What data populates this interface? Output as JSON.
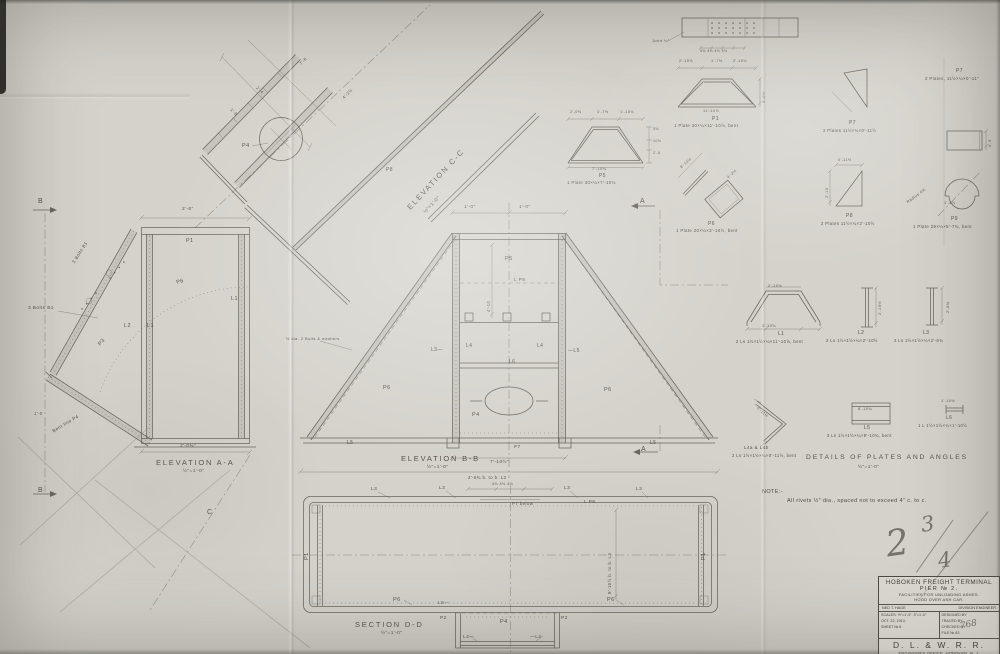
{
  "title_block": {
    "title": "HOBOKEN FREIGHT TERMINAL",
    "subtitle": "PIER № 2.",
    "line1": "FACILITIES FOR UNLOADING ASHES.",
    "line2": "HOOD OVER ASH CAR.",
    "engineer_name": "NED T. HAGE",
    "engineer_title": "DIVISION ENGINEER",
    "scales": "SCALES: ½″=1'-0″, 3″=1'-0″",
    "date": "OCT. 22, 1913.",
    "sheet": "SHEET № 6",
    "designed_by": "DESIGNED BY",
    "traced_by": "TRACED BY",
    "checked_by": "CHECKED BY",
    "file": "FILE № 63",
    "railroad": "D. L. & W. R. R.",
    "office": "ENGINEER'S OFFICE, HOBOKEN, N. J.",
    "chief": "G. J. RAY, CHIEF ENGINEER."
  },
  "pencil_mark": {
    "value": "2 3/4",
    "whole": "2",
    "numerator": "3",
    "denominator": "4",
    "check_mark": "768"
  },
  "note": {
    "heading": "NOTE:-",
    "text": "All rivets ½″ dia., spaced not to exceed 4″ c. to c."
  },
  "views": [
    {
      "id": "elevation-cc",
      "title": "ELEVATION C-C",
      "scale": "½″=1'-0″",
      "tx": 406,
      "ty": 206,
      "ts": 7.5,
      "tr": -47,
      "sx": 424,
      "sy": 212
    },
    {
      "id": "elevation-aa",
      "title": "ELEVATION A-A",
      "scale": "½″=1'-0″",
      "tx": 156,
      "ty": 459,
      "ts": 7.5,
      "tr": 0,
      "sx": 183,
      "sy": 470
    },
    {
      "id": "elevation-bb",
      "title": "ELEVATION B-B",
      "scale": "½″=1'-0″",
      "tx": 401,
      "ty": 455,
      "ts": 7.5,
      "tr": 0,
      "sx": 427,
      "sy": 466
    },
    {
      "id": "section-dd",
      "title": "SECTION D-D",
      "scale": "½″=1'-0″",
      "tx": 355,
      "ty": 621,
      "ts": 7.5,
      "tr": 0,
      "sx": 381,
      "sy": 632
    },
    {
      "id": "details",
      "title": "DETAILS OF PLATES AND ANGLES",
      "scale": "½″=1'-0″",
      "tx": 806,
      "ty": 455,
      "ts": 6.8,
      "tr": 0,
      "sx": 858,
      "sy": 466
    }
  ],
  "annotations": [
    {
      "t": "P4",
      "x": 242,
      "y": 144,
      "s": 5.5
    },
    {
      "t": "P8",
      "x": 386,
      "y": 168,
      "s": 5
    },
    {
      "t": "7'-6",
      "x": 299,
      "y": 63,
      "s": 4.2,
      "r": -46
    },
    {
      "t": "4'-2½",
      "x": 342,
      "y": 97,
      "s": 4.2,
      "r": -46
    },
    {
      "t": "2'-4",
      "x": 258,
      "y": 86,
      "s": 4.2,
      "r": 44
    },
    {
      "t": "1'-8",
      "x": 232,
      "y": 108,
      "s": 4.2,
      "r": 44
    },
    {
      "t": "B",
      "x": 38,
      "y": 198,
      "s": 7
    },
    {
      "t": "B",
      "x": 38,
      "y": 487,
      "s": 7
    },
    {
      "t": "2'-6″",
      "x": 182,
      "y": 208,
      "s": 4.8
    },
    {
      "t": "P1",
      "x": 186,
      "y": 239,
      "s": 5.5
    },
    {
      "t": "P6",
      "x": 176,
      "y": 281,
      "s": 5.5,
      "r": -14
    },
    {
      "t": "L2",
      "x": 124,
      "y": 324,
      "s": 5.5
    },
    {
      "t": "L1",
      "x": 147,
      "y": 324,
      "s": 5.5
    },
    {
      "t": "L1",
      "x": 231,
      "y": 297,
      "s": 5.5
    },
    {
      "t": "3 Bolts B1",
      "x": 28,
      "y": 307,
      "s": 4.8
    },
    {
      "t": "3 Bolts B1",
      "x": 72,
      "y": 262,
      "s": 4.5,
      "r": -58
    },
    {
      "t": "P3",
      "x": 98,
      "y": 344,
      "s": 5.5,
      "r": -50
    },
    {
      "t": "Bent line P4",
      "x": 52,
      "y": 430,
      "s": 4.6,
      "r": -31
    },
    {
      "t": "1'-0",
      "x": 34,
      "y": 412,
      "s": 4.2
    },
    {
      "t": "2'-0⅜″",
      "x": 180,
      "y": 445,
      "s": 4.8
    },
    {
      "t": "C",
      "x": 207,
      "y": 509,
      "s": 7
    },
    {
      "t": "1'-0″",
      "x": 464,
      "y": 206,
      "s": 4.8
    },
    {
      "t": "1'-0″",
      "x": 519,
      "y": 206,
      "s": 4.8
    },
    {
      "t": "A",
      "x": 640,
      "y": 198,
      "s": 7
    },
    {
      "t": "A",
      "x": 641,
      "y": 446,
      "s": 7
    },
    {
      "t": "P5",
      "x": 505,
      "y": 257,
      "s": 5.5
    },
    {
      "t": "L P8",
      "x": 514,
      "y": 279,
      "s": 4.8
    },
    {
      "t": "4'-10",
      "x": 487,
      "y": 312,
      "s": 4.2,
      "r": -90
    },
    {
      "t": "L3—",
      "x": 431,
      "y": 348,
      "s": 5
    },
    {
      "t": "L4",
      "x": 466,
      "y": 344,
      "s": 5
    },
    {
      "t": "L4",
      "x": 537,
      "y": 344,
      "s": 5
    },
    {
      "t": "—L5",
      "x": 568,
      "y": 349,
      "s": 5
    },
    {
      "t": "L6",
      "x": 509,
      "y": 360,
      "s": 5
    },
    {
      "t": "P6",
      "x": 383,
      "y": 386,
      "s": 5.5
    },
    {
      "t": "P6",
      "x": 604,
      "y": 388,
      "s": 5.5
    },
    {
      "t": "P4",
      "x": 472,
      "y": 413,
      "s": 5.5
    },
    {
      "t": "L5",
      "x": 347,
      "y": 441,
      "s": 5
    },
    {
      "t": "L5",
      "x": 650,
      "y": 441,
      "s": 5
    },
    {
      "t": "P7",
      "x": 514,
      "y": 446,
      "s": 4.8
    },
    {
      "t": "½ dia. 2 Bolts & washers",
      "x": 286,
      "y": 337,
      "s": 4
    },
    {
      "t": "7'-10½″",
      "x": 490,
      "y": 461,
      "s": 4.8
    },
    {
      "t": "2'-6¾ b. to b. L3",
      "x": 468,
      "y": 476,
      "s": 4.4
    },
    {
      "t": "4⅛ 4⅛ 4⅛",
      "x": 492,
      "y": 483,
      "s": 3.8
    },
    {
      "t": "L3",
      "x": 371,
      "y": 488,
      "s": 4.8
    },
    {
      "t": "L3",
      "x": 439,
      "y": 487,
      "s": 4.8
    },
    {
      "t": "L3",
      "x": 564,
      "y": 487,
      "s": 4.8
    },
    {
      "t": "L3",
      "x": 636,
      "y": 488,
      "s": 4.8
    },
    {
      "t": "P7 below",
      "x": 512,
      "y": 502,
      "s": 4.4
    },
    {
      "t": "L P8",
      "x": 584,
      "y": 501,
      "s": 4.8
    },
    {
      "t": "8'-10½ b. to b. L3",
      "x": 608,
      "y": 594,
      "s": 4.4,
      "r": -90
    },
    {
      "t": "P1",
      "x": 305,
      "y": 560,
      "s": 5.5,
      "r": -90
    },
    {
      "t": "P1",
      "x": 702,
      "y": 560,
      "s": 5.5,
      "r": -90
    },
    {
      "t": "P6",
      "x": 393,
      "y": 598,
      "s": 5.5
    },
    {
      "t": "P6",
      "x": 607,
      "y": 598,
      "s": 5.5
    },
    {
      "t": "L6—",
      "x": 438,
      "y": 602,
      "s": 4.8
    },
    {
      "t": "P2",
      "x": 440,
      "y": 617,
      "s": 4.8
    },
    {
      "t": "P2",
      "x": 561,
      "y": 617,
      "s": 4.8
    },
    {
      "t": "P4",
      "x": 500,
      "y": 620,
      "s": 5.5
    },
    {
      "t": "L4—",
      "x": 463,
      "y": 636,
      "s": 4.8
    },
    {
      "t": "—L4",
      "x": 530,
      "y": 636,
      "s": 4.8
    },
    {
      "t": "Joint ¼″",
      "x": 652,
      "y": 39,
      "s": 4
    },
    {
      "t": "4⅛ 4⅛ 4⅛ 4⅛",
      "x": 700,
      "y": 50,
      "s": 3.6
    },
    {
      "t": "2'-10⅛",
      "x": 679,
      "y": 60,
      "s": 3.8
    },
    {
      "t": "1'-7½",
      "x": 711,
      "y": 60,
      "s": 3.8
    },
    {
      "t": "2'-10⅛",
      "x": 733,
      "y": 60,
      "s": 3.8
    },
    {
      "t": "3'-0½",
      "x": 763,
      "y": 103,
      "s": 3.8,
      "r": -90
    },
    {
      "t": "11'-10⅞",
      "x": 703,
      "y": 110,
      "s": 3.8
    },
    {
      "t": "P1",
      "x": 712,
      "y": 117,
      "s": 5
    },
    {
      "t": "1 Plate 30×¼×11'-10⅞, bent",
      "x": 674,
      "y": 124,
      "s": 4.3
    },
    {
      "t": "2'-0⅜",
      "x": 570,
      "y": 111,
      "s": 3.8
    },
    {
      "t": "1'-7½",
      "x": 597,
      "y": 111,
      "s": 3.8
    },
    {
      "t": "1'-10⅛",
      "x": 620,
      "y": 111,
      "s": 3.8
    },
    {
      "t": "3⅛",
      "x": 653,
      "y": 128,
      "s": 3.6
    },
    {
      "t": "10¾",
      "x": 653,
      "y": 140,
      "s": 3.6
    },
    {
      "t": "2'-6",
      "x": 653,
      "y": 152,
      "s": 3.6
    },
    {
      "t": "7'-10⅛",
      "x": 592,
      "y": 167,
      "s": 4
    },
    {
      "t": "P5",
      "x": 599,
      "y": 174,
      "s": 5
    },
    {
      "t": "1 Plate 30×¼×7'-10⅛",
      "x": 567,
      "y": 181,
      "s": 4.3
    },
    {
      "t": "8'-10½",
      "x": 680,
      "y": 167,
      "s": 3.8,
      "r": -42
    },
    {
      "t": "4'-2½",
      "x": 727,
      "y": 177,
      "s": 3.8,
      "r": -42
    },
    {
      "t": "P6",
      "x": 708,
      "y": 222,
      "s": 5
    },
    {
      "t": "1 Plate 20×¼×3'-10½, bent",
      "x": 676,
      "y": 229,
      "s": 4.3
    },
    {
      "t": "P7",
      "x": 956,
      "y": 69,
      "s": 5
    },
    {
      "t": "2 Plates, 11½×¼×0'-11″",
      "x": 925,
      "y": 77,
      "s": 4.3
    },
    {
      "t": "P7",
      "x": 849,
      "y": 121,
      "s": 5
    },
    {
      "t": "2 Plates 11½×¼×0'-11½",
      "x": 823,
      "y": 129,
      "s": 4.2
    },
    {
      "t": "0'-11½",
      "x": 838,
      "y": 159,
      "s": 3.8
    },
    {
      "t": "2'-10",
      "x": 826,
      "y": 198,
      "s": 3.8,
      "r": -90
    },
    {
      "t": "P8",
      "x": 846,
      "y": 214,
      "s": 5
    },
    {
      "t": "2 Plates 11½×¼×2'-10½",
      "x": 821,
      "y": 222,
      "s": 4.2
    },
    {
      "t": "0'-9",
      "x": 989,
      "y": 147,
      "s": 3.8,
      "r": -90
    },
    {
      "t": "Radius 4¾",
      "x": 906,
      "y": 201,
      "s": 4,
      "r": -36
    },
    {
      "t": "1'-4⅞",
      "x": 944,
      "y": 202,
      "s": 3.8
    },
    {
      "t": "P9",
      "x": 951,
      "y": 217,
      "s": 5
    },
    {
      "t": "1 Plate 29×¼×5'-7¾, bent",
      "x": 913,
      "y": 225,
      "s": 4.3
    },
    {
      "t": "2'-10⅛",
      "x": 768,
      "y": 285,
      "s": 3.8
    },
    {
      "t": "3'-10⅛",
      "x": 762,
      "y": 325,
      "s": 3.8
    },
    {
      "t": "L1",
      "x": 778,
      "y": 332,
      "s": 5
    },
    {
      "t": "2 Ls 1½×1½×¼×11'-10⅞, bent",
      "x": 736,
      "y": 340,
      "s": 4.2
    },
    {
      "t": "2'-10½",
      "x": 879,
      "y": 315,
      "s": 3.8,
      "r": -90
    },
    {
      "t": "L2",
      "x": 858,
      "y": 331,
      "s": 5
    },
    {
      "t": "2 Ls 1½×1½×¼×2'-10½",
      "x": 826,
      "y": 339,
      "s": 4.2
    },
    {
      "t": "2'-6¾",
      "x": 947,
      "y": 313,
      "s": 3.8,
      "r": -90
    },
    {
      "t": "L3",
      "x": 923,
      "y": 331,
      "s": 5
    },
    {
      "t": "2 Ls 1½×1½×¼×2'-6¾",
      "x": 894,
      "y": 339,
      "s": 4.2
    },
    {
      "t": "0'-11½",
      "x": 758,
      "y": 407,
      "s": 3.8,
      "r": 41
    },
    {
      "t": "L4a & L4b",
      "x": 744,
      "y": 446,
      "s": 4.6
    },
    {
      "t": "2 Ls 1½×1½×¼×0'-11½, bent",
      "x": 732,
      "y": 454,
      "s": 4.2
    },
    {
      "t": "8'-10¾",
      "x": 858,
      "y": 408,
      "s": 3.8
    },
    {
      "t": "L5",
      "x": 864,
      "y": 426,
      "s": 5
    },
    {
      "t": "3 Ls 1½×1½×¼×8'-10¾, bent",
      "x": 827,
      "y": 434,
      "s": 4.2
    },
    {
      "t": "1'-10½",
      "x": 941,
      "y": 400,
      "s": 3.8
    },
    {
      "t": "L6",
      "x": 946,
      "y": 416,
      "s": 5
    },
    {
      "t": "1 L 1½×1½×¼×1'-10½",
      "x": 918,
      "y": 424,
      "s": 4.2
    }
  ]
}
